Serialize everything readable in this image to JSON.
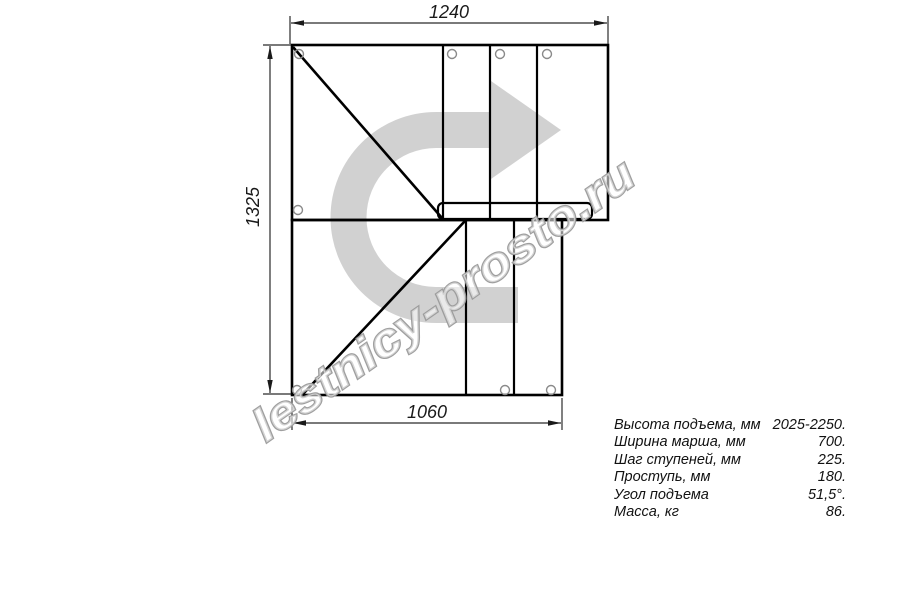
{
  "drawing": {
    "title_hint": "L-shaped staircase floor plan with 90-degree turn",
    "dimensions": {
      "top": "1240",
      "left": "1325",
      "bottom": "1060"
    },
    "watermark": "lestnicy-prosto.ru",
    "colors": {
      "outline": "#000000",
      "dimension": "#2a2a2a",
      "direction_arrow": "rgba(0,0,0,0.18)",
      "hole_stroke": "#8a8a8a",
      "watermark_stroke": "#9a9a9a"
    }
  },
  "specs": {
    "rows": [
      {
        "label": "Высота подъема, мм",
        "value": "2025-2250."
      },
      {
        "label": "Ширина марша, мм",
        "value": "700."
      },
      {
        "label": "Шаг ступеней, мм",
        "value": "225."
      },
      {
        "label": "Проступь, мм",
        "value": "180."
      },
      {
        "label": "Угол подъема",
        "value": "51,5°."
      },
      {
        "label": "Масса, кг",
        "value": "86."
      }
    ]
  }
}
